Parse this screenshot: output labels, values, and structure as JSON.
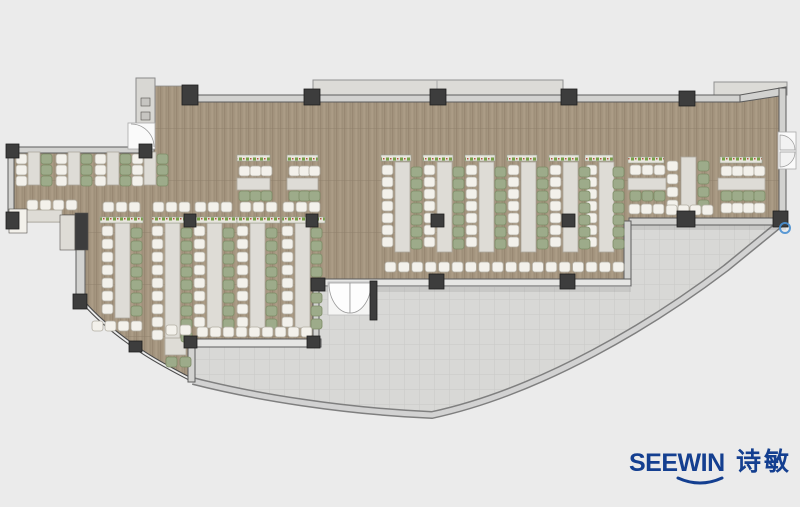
{
  "page": {
    "background": "#ebebeb",
    "width": 800,
    "height": 507,
    "description": "office canteen furniture layout floor plan"
  },
  "branding": {
    "logo_text": "SEEWIN",
    "logo_cjk": "诗敏",
    "logo_color": "#143f90"
  },
  "palette": {
    "background": "#ebebeb",
    "floor": "#a4957f",
    "terrace": "#d8d8d6",
    "terrace_line": "#c9c9c7",
    "table": "#dedcd6",
    "table_border": "#ada89d",
    "chair_white": "#f3f1eb",
    "chair_white_border": "#b2aea3",
    "chair_green": "#9dab8a",
    "chair_green_border": "#7d8c66",
    "column": "#3d3d3d",
    "column_border": "#1f1f1f",
    "wall_fill": "#d2d2d0",
    "wall_line": "#5c5c5c",
    "canopy": "#dcdbd7",
    "panel_mark": "#c6c5c1",
    "marker_blue": "#4a90d2"
  },
  "floor_plan": {
    "columns": [
      [
        182,
        85,
        16,
        20
      ],
      [
        304,
        89,
        16,
        16
      ],
      [
        430,
        89,
        16,
        16
      ],
      [
        561,
        89,
        16,
        16
      ],
      [
        679,
        91,
        16,
        15
      ],
      [
        139,
        144,
        13,
        14
      ],
      [
        6,
        144,
        13,
        14
      ],
      [
        6,
        212,
        13,
        17
      ],
      [
        73,
        294,
        14,
        15
      ],
      [
        129,
        341,
        13,
        11
      ],
      [
        184,
        336,
        13,
        12
      ],
      [
        307,
        336,
        13,
        12
      ],
      [
        184,
        214,
        12,
        13
      ],
      [
        306,
        214,
        12,
        13
      ],
      [
        431,
        214,
        13,
        13
      ],
      [
        562,
        214,
        13,
        13
      ],
      [
        429,
        274,
        15,
        15
      ],
      [
        560,
        274,
        15,
        15
      ],
      [
        311,
        278,
        14,
        13
      ],
      [
        370,
        281,
        7,
        39
      ],
      [
        677,
        211,
        18,
        16
      ],
      [
        773,
        211,
        15,
        16
      ]
    ],
    "tables": [
      [
        28,
        152,
        12,
        33
      ],
      [
        68,
        152,
        12,
        33
      ],
      [
        107,
        152,
        12,
        33
      ],
      [
        144,
        152,
        12,
        33
      ],
      [
        16,
        210,
        46,
        12
      ],
      [
        115,
        223,
        15,
        95
      ],
      [
        165,
        223,
        15,
        125
      ],
      [
        207,
        223,
        15,
        105
      ],
      [
        250,
        223,
        15,
        105
      ],
      [
        295,
        223,
        15,
        105
      ],
      [
        237,
        178,
        33,
        12
      ],
      [
        287,
        178,
        31,
        12
      ],
      [
        395,
        162,
        15,
        90
      ],
      [
        437,
        162,
        15,
        90
      ],
      [
        479,
        162,
        15,
        90
      ],
      [
        521,
        162,
        15,
        90
      ],
      [
        563,
        162,
        15,
        90
      ],
      [
        599,
        162,
        15,
        90
      ],
      [
        681,
        157,
        15,
        50
      ],
      [
        628,
        178,
        38,
        12
      ],
      [
        718,
        178,
        47,
        12
      ],
      [
        165,
        338,
        21,
        17
      ]
    ],
    "plant_strips": [
      [
        100,
        217,
        43,
        6
      ],
      [
        152,
        217,
        43,
        6
      ],
      [
        194,
        217,
        43,
        6
      ],
      [
        237,
        217,
        43,
        6
      ],
      [
        282,
        217,
        43,
        6
      ],
      [
        237,
        155,
        33,
        6
      ],
      [
        287,
        155,
        31,
        6
      ],
      [
        381,
        155,
        30,
        6
      ],
      [
        423,
        155,
        30,
        6
      ],
      [
        465,
        155,
        30,
        6
      ],
      [
        507,
        155,
        30,
        6
      ],
      [
        549,
        155,
        30,
        6
      ],
      [
        585,
        155,
        28,
        6
      ],
      [
        628,
        157,
        36,
        6
      ],
      [
        720,
        157,
        42,
        6
      ]
    ],
    "chair_cols": [
      [
        16,
        154,
        3,
        11,
        "w"
      ],
      [
        56,
        154,
        3,
        11,
        "w"
      ],
      [
        95,
        154,
        3,
        11,
        "w"
      ],
      [
        132,
        154,
        3,
        11,
        "w"
      ],
      [
        41,
        154,
        3,
        11,
        "g"
      ],
      [
        81,
        154,
        3,
        11,
        "g"
      ],
      [
        120,
        154,
        3,
        11,
        "g"
      ],
      [
        157,
        154,
        3,
        11,
        "g"
      ],
      [
        102,
        226,
        7,
        13,
        "w"
      ],
      [
        152,
        226,
        9,
        13,
        "w"
      ],
      [
        194,
        226,
        8,
        13,
        "w"
      ],
      [
        237,
        226,
        8,
        13,
        "w"
      ],
      [
        282,
        226,
        8,
        13,
        "w"
      ],
      [
        131,
        228,
        7,
        13,
        "g"
      ],
      [
        181,
        228,
        9,
        13,
        "g"
      ],
      [
        223,
        228,
        8,
        13,
        "g"
      ],
      [
        266,
        228,
        8,
        13,
        "g"
      ],
      [
        311,
        228,
        8,
        13,
        "g"
      ],
      [
        382,
        165,
        7,
        12,
        "w"
      ],
      [
        424,
        165,
        7,
        12,
        "w"
      ],
      [
        466,
        165,
        7,
        12,
        "w"
      ],
      [
        508,
        165,
        7,
        12,
        "w"
      ],
      [
        550,
        165,
        7,
        12,
        "w"
      ],
      [
        586,
        165,
        7,
        12,
        "w"
      ],
      [
        411,
        167,
        7,
        12,
        "g"
      ],
      [
        453,
        167,
        7,
        12,
        "g"
      ],
      [
        495,
        167,
        7,
        12,
        "g"
      ],
      [
        537,
        167,
        7,
        12,
        "g"
      ],
      [
        579,
        167,
        7,
        12,
        "g"
      ],
      [
        613,
        167,
        7,
        12,
        "g"
      ],
      [
        667,
        161,
        4,
        13,
        "w"
      ],
      [
        698,
        161,
        4,
        13,
        "g"
      ]
    ],
    "chair_rows": [
      [
        27,
        200,
        4,
        13,
        "w"
      ],
      [
        103,
        202,
        3,
        13,
        "w"
      ],
      [
        153,
        202,
        3,
        13,
        "w"
      ],
      [
        195,
        202,
        3,
        13,
        "w"
      ],
      [
        240,
        202,
        3,
        13,
        "w"
      ],
      [
        283,
        202,
        3,
        13,
        "w"
      ],
      [
        92,
        321,
        4,
        13,
        "w"
      ],
      [
        197,
        327,
        9,
        13,
        "w"
      ],
      [
        166,
        325,
        2,
        14,
        "w"
      ],
      [
        166,
        357,
        2,
        14,
        "g"
      ],
      [
        239,
        166,
        3,
        11,
        "w"
      ],
      [
        289,
        166,
        3,
        10,
        "w"
      ],
      [
        239,
        191,
        3,
        11,
        "g"
      ],
      [
        289,
        191,
        3,
        10,
        "g"
      ],
      [
        385,
        262,
        18,
        13.4,
        "w"
      ],
      [
        630,
        165,
        3,
        12,
        "w"
      ],
      [
        630,
        191,
        3,
        12,
        "g"
      ],
      [
        629,
        204,
        3,
        12,
        "w"
      ],
      [
        666,
        205,
        4,
        12,
        "w"
      ],
      [
        721,
        166,
        4,
        11,
        "w"
      ],
      [
        721,
        191,
        4,
        11,
        "g"
      ],
      [
        721,
        203,
        4,
        11,
        "w"
      ]
    ],
    "misc_rects": [
      [
        60,
        215,
        15,
        35,
        "table",
        "service-counter"
      ],
      [
        75,
        213,
        13,
        37,
        "column",
        "storage-cabinet"
      ],
      [
        9,
        209,
        18,
        24,
        "chair_white",
        "side-table"
      ],
      [
        141,
        98,
        9,
        8,
        "panel_mark",
        "panel-button"
      ],
      [
        141,
        112,
        9,
        8,
        "panel_mark",
        "panel-button"
      ]
    ]
  }
}
